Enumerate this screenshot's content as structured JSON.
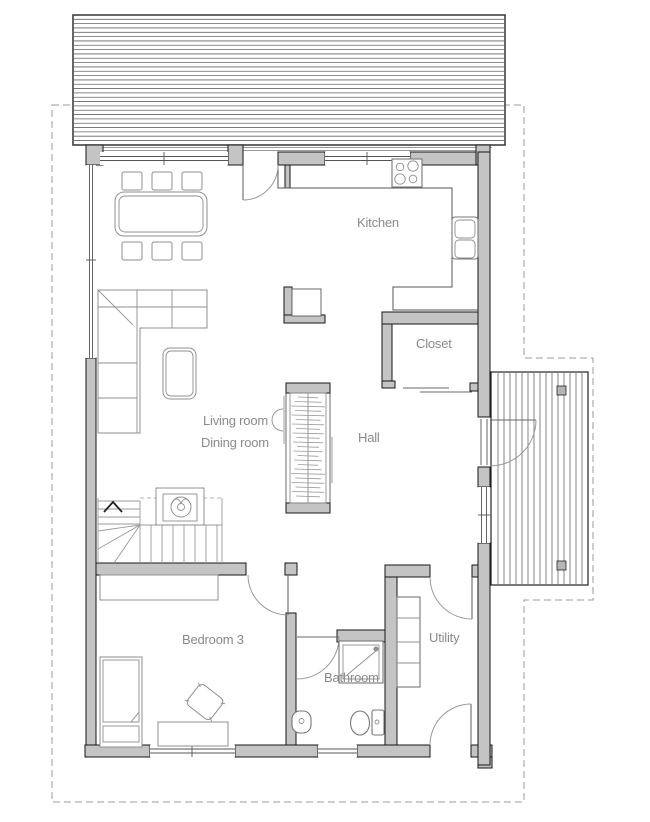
{
  "plan_type": "single-floor house plan",
  "rooms": {
    "kitchen": {
      "label": "Kitchen"
    },
    "closet": {
      "label": "Closet"
    },
    "living": {
      "label": "Living room"
    },
    "dining": {
      "label": "Dining room"
    },
    "hall": {
      "label": "Hall"
    },
    "bedroom3": {
      "label": "Bedroom 3"
    },
    "bathroom": {
      "label": "Bathroom"
    },
    "utility": {
      "label": "Utility"
    }
  },
  "colors": {
    "wall_fill": "#c4c4c4",
    "wall_stroke": "#161616",
    "furniture_line": "#8f8f8f",
    "door_swing": "#9a9a9a",
    "label_text": "#8a8a8a",
    "boundary_dash": "#9b9b9b",
    "hatch_line": "#666666"
  }
}
